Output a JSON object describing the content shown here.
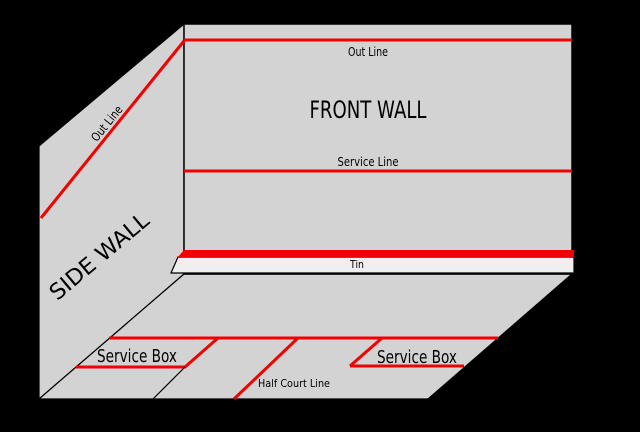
{
  "diagram": {
    "type": "squash-court-perspective",
    "walls": {
      "front_wall_title": "FRONT WALL",
      "side_wall_title": "SIDE WALL"
    },
    "labels": {
      "out_line_front": "Out Line",
      "out_line_side": "Out Line",
      "service_line": "Service Line",
      "tin": "Tin",
      "service_box_left": "Service Box",
      "service_box_right": "Service Box",
      "half_court_line": "Half Court Line"
    },
    "colors": {
      "background": "#000000",
      "wall_fill": "#d3d3d3",
      "floor_fill": "#d3d3d3",
      "tin_board_fill": "#efefef",
      "court_line_red": "#f20000",
      "edge_black": "#000000",
      "text": "#000000"
    }
  }
}
